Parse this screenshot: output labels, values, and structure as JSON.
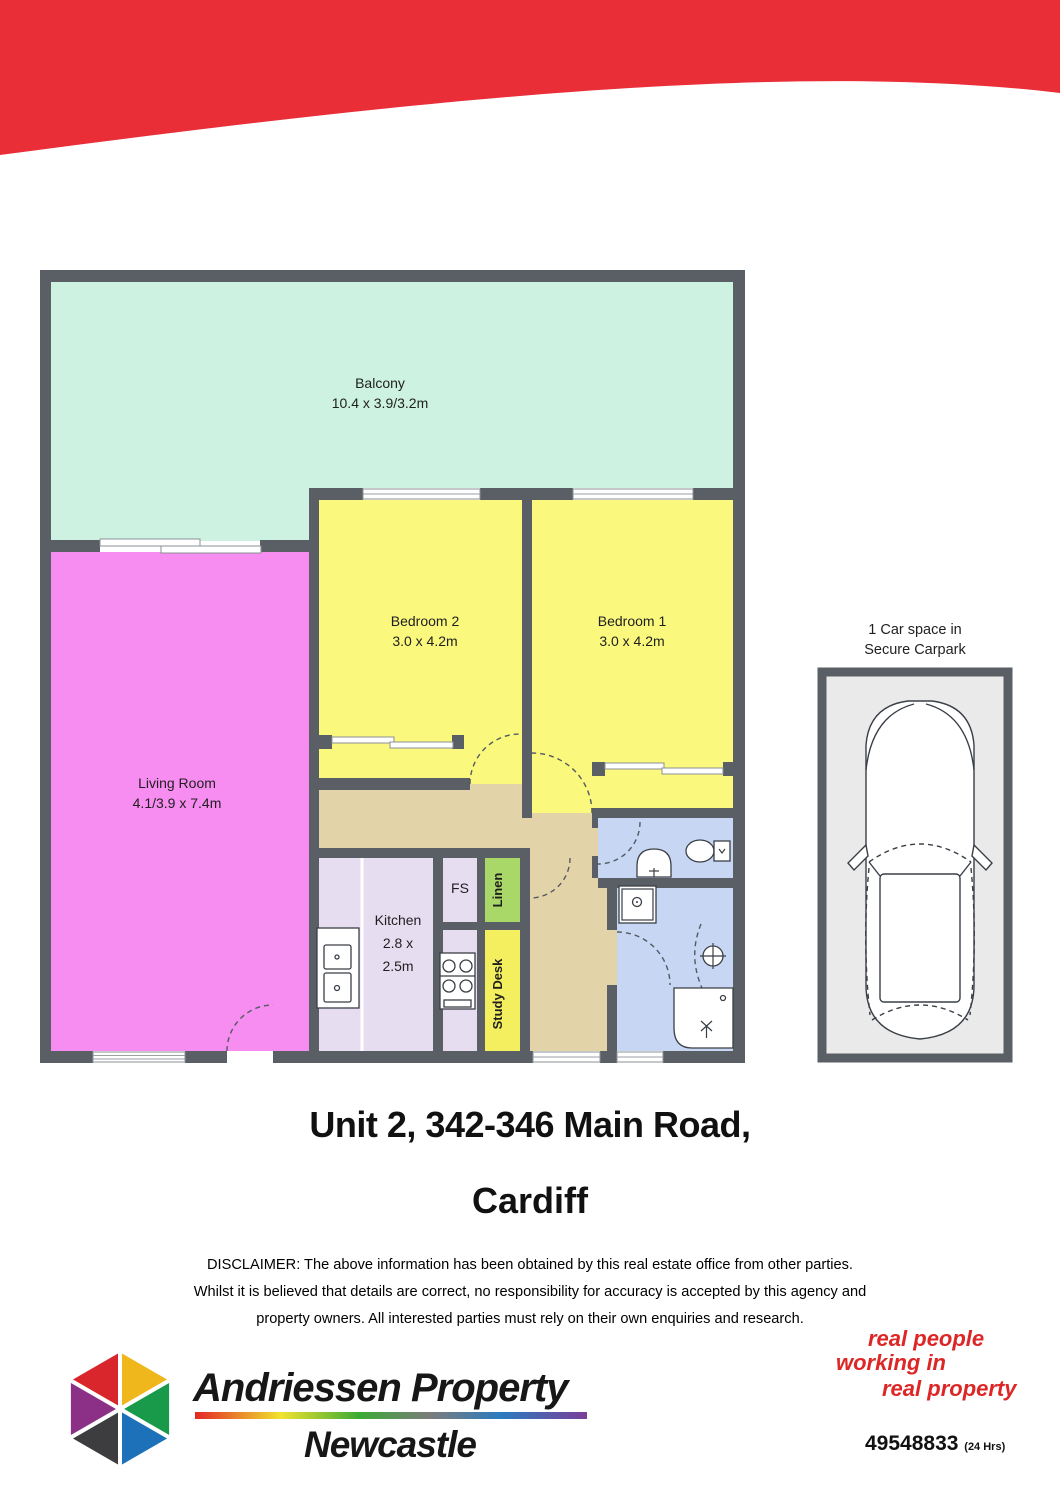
{
  "palette": {
    "banner-red": "#ea2e37",
    "slogan-red": "#dd2727",
    "wall": "#5a5f66",
    "balcony": "#cdf2e2",
    "bedroom": "#faf87d",
    "living": "#f78df1",
    "kitchen": "#e7ddf0",
    "hall": "#e2d3a8",
    "bath": "#c6d6f3",
    "linen": "#a9d768",
    "study": "#f4ef5f",
    "carport-fill": "#eaeaea",
    "logo-red": "#d8262c",
    "logo-yellow": "#efb71c",
    "logo-green": "#189a4a",
    "logo-blue": "#1c71b8",
    "logo-dark": "#3d3d3f",
    "logo-purple": "#8c2f86"
  },
  "plan": {
    "balcony_name": "Balcony",
    "balcony_dims": "10.4 x 3.9/3.2m",
    "living_name": "Living Room",
    "living_dims": "4.1/3.9 x 7.4m",
    "bedroom2_name": "Bedroom 2",
    "bedroom2_dims": "3.0 x 4.2m",
    "bedroom1_name": "Bedroom 1",
    "bedroom1_dims": "3.0 x 4.2m",
    "kitchen_name": "Kitchen",
    "kitchen_dims1": "2.8 x",
    "kitchen_dims2": "2.5m",
    "fs_label": "FS",
    "linen_label": "Linen",
    "study_label": "Study Desk"
  },
  "carport": {
    "line1": "1 Car space in",
    "line2": "Secure Carpark"
  },
  "address": {
    "line1": "Unit 2, 342-346 Main Road,",
    "line2": "Cardiff"
  },
  "disclaimer": {
    "lines": [
      "DISCLAIMER: The above information has been obtained by this real estate office from other parties.",
      "Whilst it is believed that details are correct, no responsibility for accuracy is accepted by this agency and",
      "property owners. All interested parties must rely on their own enquiries and research."
    ]
  },
  "footer": {
    "brand_line1": "Andriessen Property",
    "brand_line2": "Newcastle",
    "slogan_lines": [
      "real people",
      "working in",
      "real property"
    ],
    "phone": "49548833",
    "phone_note": "(24 Hrs)"
  }
}
